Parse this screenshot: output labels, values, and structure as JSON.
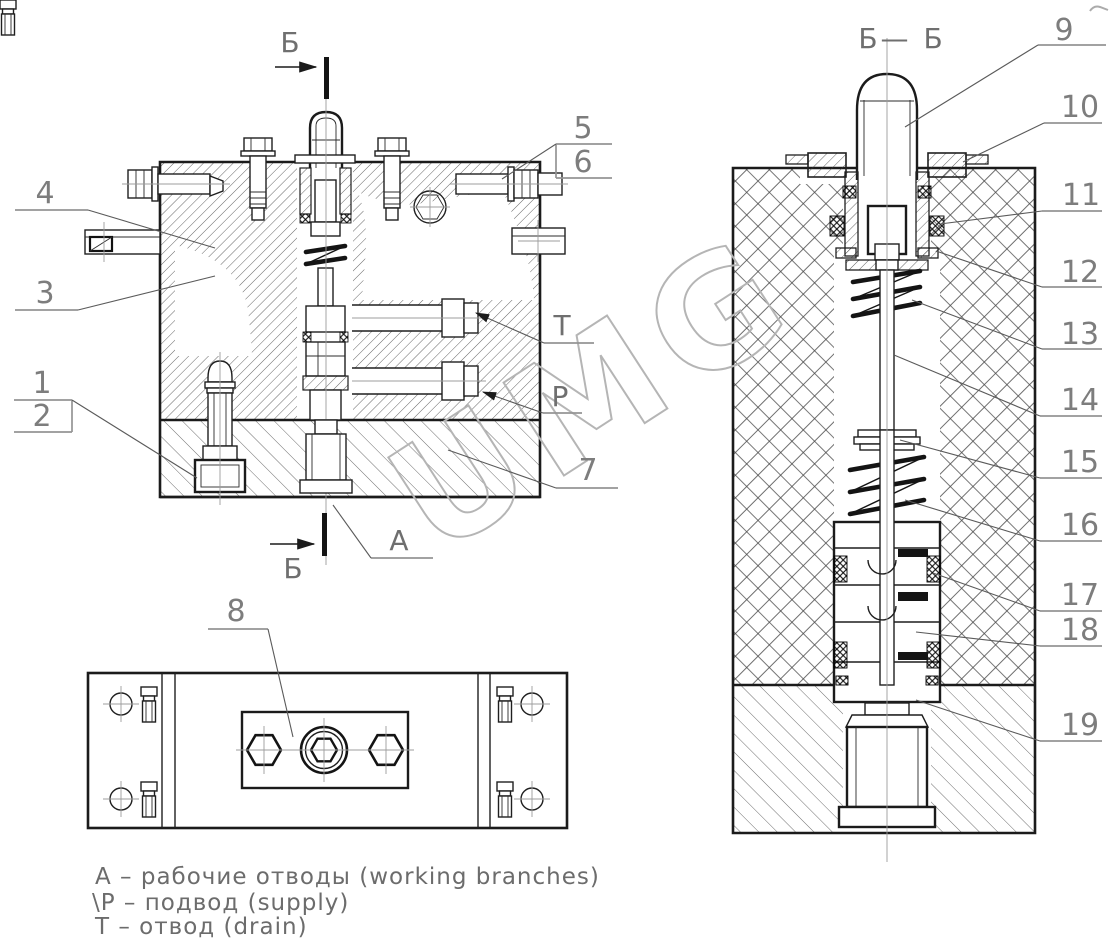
{
  "drawing": {
    "type": "hydraulic-valve-assembly-drawing",
    "watermark": "UMG",
    "section_marker_top": "Б",
    "section_marker_bottom": "Б",
    "section_view_title": "Б— Б",
    "line_color": "#1b1b1b",
    "callout_color": "#7d7d7d",
    "callouts": {
      "n1": "1",
      "n2": "2",
      "n3": "3",
      "n4": "4",
      "n5": "5",
      "n6": "6",
      "n7": "7",
      "n8": "8",
      "n9": "9",
      "n10": "10",
      "n11": "11",
      "n12": "12",
      "n13": "13",
      "n14": "14",
      "n15": "15",
      "n16": "16",
      "n17": "17",
      "n18": "18",
      "n19": "19"
    },
    "ports": {
      "a": "А",
      "p": "Р",
      "t": "Т"
    },
    "legend": {
      "line1": "А –  рабочие отводы (working branches)",
      "line2": "\\Р –  подвод (supply)",
      "line3": "Т –  отвод (drain)"
    }
  }
}
